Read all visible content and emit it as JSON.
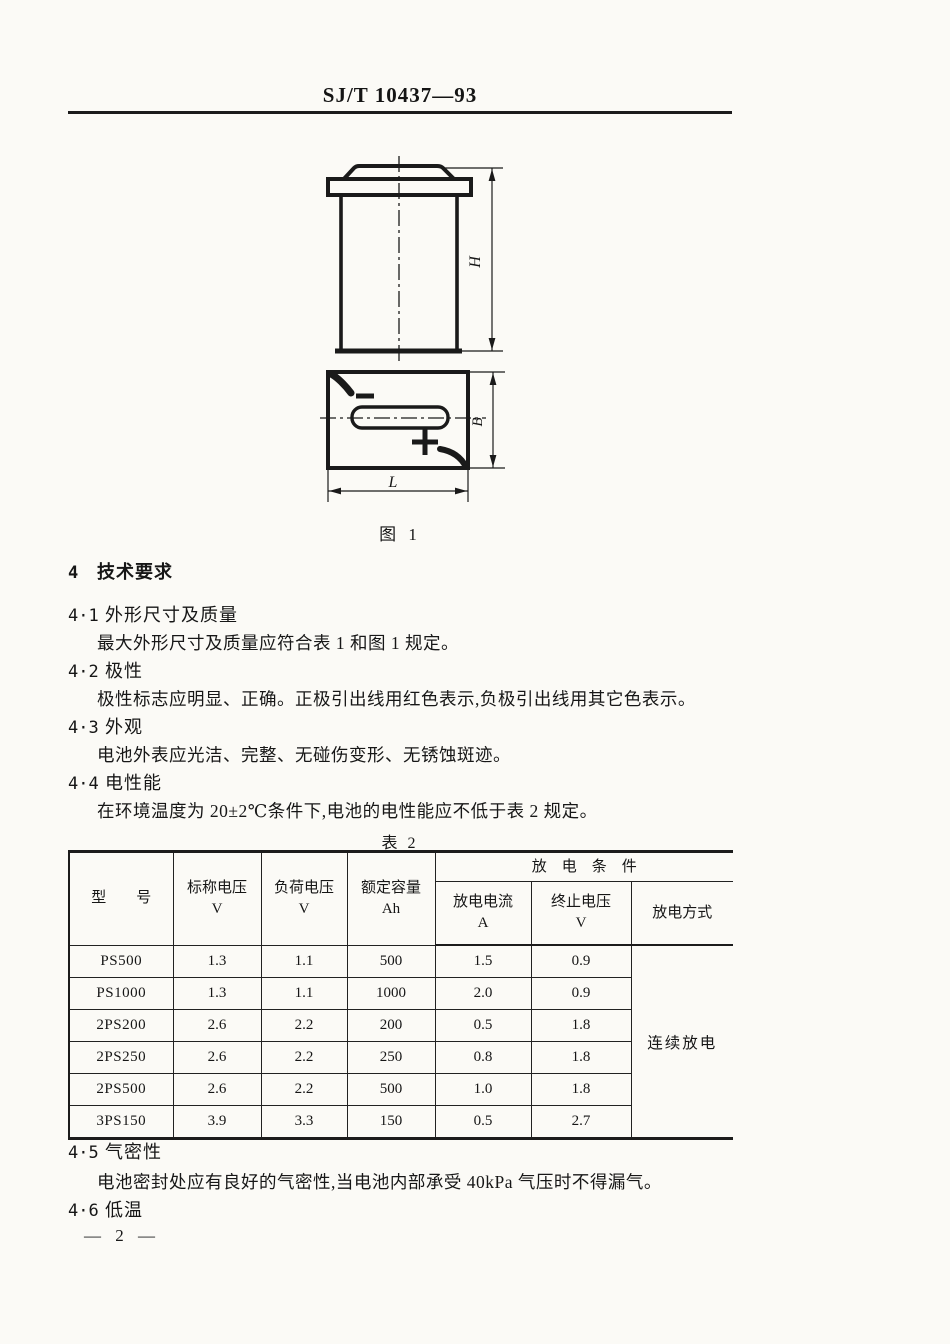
{
  "page": {
    "header_code": "SJ/T 10437—93",
    "footer_page": "— 2 —"
  },
  "figure": {
    "caption": "图 1",
    "dim_height_label": "H",
    "dim_width_label": "B",
    "dim_length_label": "L",
    "polarity_negative": "−",
    "polarity_positive": "+"
  },
  "sections": [
    {
      "num": "4",
      "title": "技术要求",
      "body": ""
    },
    {
      "num": "4·1",
      "title": "外形尺寸及质量",
      "body": "最大外形尺寸及质量应符合表 1 和图 1 规定。"
    },
    {
      "num": "4·2",
      "title": "极性",
      "body": "极性标志应明显、正确。正极引出线用红色表示,负极引出线用其它色表示。"
    },
    {
      "num": "4·3",
      "title": "外观",
      "body": "电池外表应光洁、完整、无碰伤变形、无锈蚀斑迹。"
    },
    {
      "num": "4·4",
      "title": "电性能",
      "body": "在环境温度为 20±2℃条件下,电池的电性能应不低于表 2 规定。"
    },
    {
      "num": "4·5",
      "title": "气密性",
      "body": "电池密封处应有良好的气密性,当电池内部承受 40kPa 气压时不得漏气。"
    },
    {
      "num": "4·6",
      "title": "低温",
      "body": ""
    }
  ],
  "table": {
    "caption": "表 2",
    "headers": {
      "model": "型　　号",
      "nominal_voltage": "标称电压",
      "nominal_voltage_unit": "V",
      "load_voltage": "负荷电压",
      "load_voltage_unit": "V",
      "rated_capacity": "额定容量",
      "rated_capacity_unit": "Ah",
      "discharge_conditions": "放　电　条　件",
      "discharge_current": "放电电流",
      "discharge_current_unit": "A",
      "end_voltage": "终止电压",
      "end_voltage_unit": "V",
      "discharge_mode": "放电方式"
    },
    "rows": [
      {
        "model": "PS500",
        "nominal": "1.3",
        "load": "1.1",
        "capacity": "500",
        "current": "1.5",
        "end": "0.9"
      },
      {
        "model": "PS1000",
        "nominal": "1.3",
        "load": "1.1",
        "capacity": "1000",
        "current": "2.0",
        "end": "0.9"
      },
      {
        "model": "2PS200",
        "nominal": "2.6",
        "load": "2.2",
        "capacity": "200",
        "current": "0.5",
        "end": "1.8"
      },
      {
        "model": "2PS250",
        "nominal": "2.6",
        "load": "2.2",
        "capacity": "250",
        "current": "0.8",
        "end": "1.8"
      },
      {
        "model": "2PS500",
        "nominal": "2.6",
        "load": "2.2",
        "capacity": "500",
        "current": "1.0",
        "end": "1.8"
      },
      {
        "model": "3PS150",
        "nominal": "3.9",
        "load": "3.3",
        "capacity": "150",
        "current": "0.5",
        "end": "2.7"
      }
    ],
    "discharge_mode_value": "连续放电"
  }
}
